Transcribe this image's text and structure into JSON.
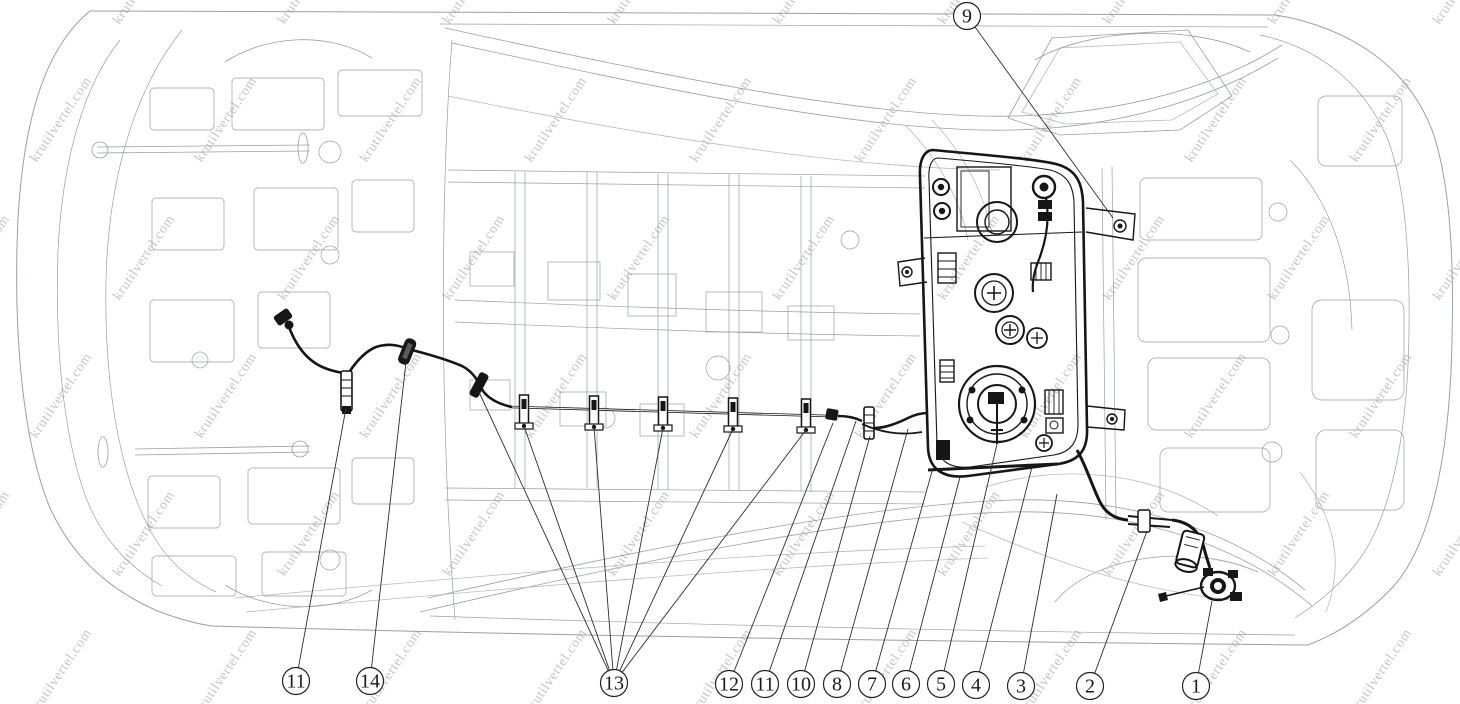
{
  "watermark": {
    "text": "krutilvertel.com",
    "color": "#c6c6c6"
  },
  "colors": {
    "body_lines": "#99a0a8",
    "body_lines_light": "#b6bbc2",
    "fuel_system": "#161616",
    "leader_lines": "#2e2e2e",
    "callout_stroke": "#222222",
    "background": "#ffffff"
  },
  "diagram": {
    "callouts": [
      {
        "label": "9",
        "cx": 967,
        "cy": 16,
        "targets": [
          [
            1113,
            218
          ]
        ]
      },
      {
        "label": "11",
        "cx": 296,
        "cy": 681,
        "targets": [
          [
            346,
            408
          ]
        ]
      },
      {
        "label": "14",
        "cx": 370,
        "cy": 681,
        "targets": [
          [
            406,
            362
          ]
        ]
      },
      {
        "label": "13",
        "cx": 614,
        "cy": 683,
        "targets": [
          [
            479,
            392
          ],
          [
            524,
            426
          ],
          [
            594,
            427
          ],
          [
            663,
            428
          ],
          [
            733,
            429
          ],
          [
            806,
            430
          ]
        ]
      },
      {
        "label": "12",
        "cx": 729,
        "cy": 684,
        "targets": [
          [
            833,
            423
          ]
        ]
      },
      {
        "label": "11",
        "cx": 765,
        "cy": 684,
        "targets": [
          [
            856,
            421
          ]
        ]
      },
      {
        "label": "10",
        "cx": 801,
        "cy": 684,
        "targets": [
          [
            870,
            436
          ]
        ]
      },
      {
        "label": "8",
        "cx": 837,
        "cy": 684,
        "targets": [
          [
            908,
            429
          ]
        ]
      },
      {
        "label": "7",
        "cx": 872,
        "cy": 684,
        "targets": [
          [
            933,
            468
          ]
        ]
      },
      {
        "label": "6",
        "cx": 906,
        "cy": 684,
        "targets": [
          [
            960,
            477
          ]
        ]
      },
      {
        "label": "5",
        "cx": 941,
        "cy": 684,
        "targets": [
          [
            997,
            444
          ]
        ]
      },
      {
        "label": "4",
        "cx": 976,
        "cy": 685,
        "targets": [
          [
            1032,
            467
          ]
        ]
      },
      {
        "label": "3",
        "cx": 1021,
        "cy": 686,
        "targets": [
          [
            1057,
            494
          ]
        ]
      },
      {
        "label": "2",
        "cx": 1090,
        "cy": 686,
        "targets": [
          [
            1147,
            531
          ]
        ]
      },
      {
        "label": "1",
        "cx": 1196,
        "cy": 686,
        "targets": [
          [
            1212,
            601
          ]
        ]
      }
    ]
  }
}
